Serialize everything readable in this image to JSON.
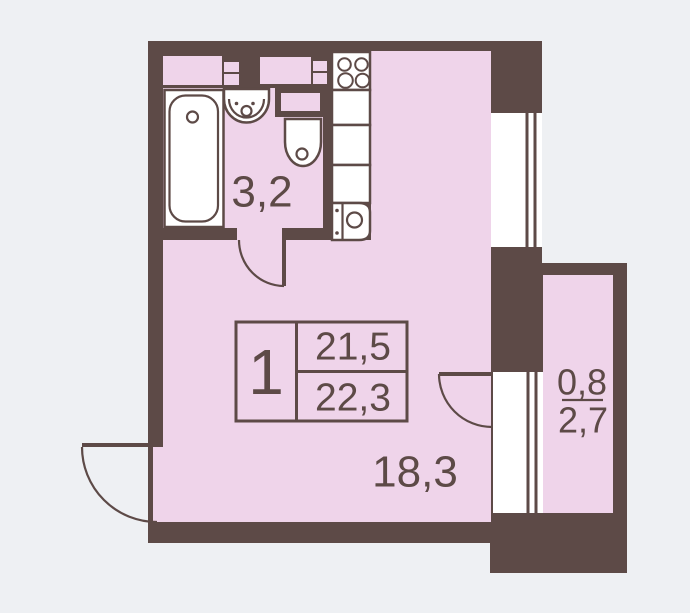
{
  "plan_title": "Studio apartment floor plan",
  "colors": {
    "wall": "#5D4A47",
    "floor": "#EFD4EA",
    "bg": "#EEF0F3",
    "fixture": "#FFFFFF"
  },
  "info_box": {
    "unit_number": "1",
    "total_area": "21,5",
    "living_area": "22,3"
  },
  "labels": {
    "bathroom_area": "3,2",
    "main_room_area": "18,3",
    "balcony_coefficient": "0,8",
    "balcony_area": "2,7"
  },
  "fixtures": [
    "bathtub",
    "washbasin",
    "toilet",
    "stove",
    "kitchen-counter",
    "kitchen-sink",
    "window",
    "balcony-door",
    "entry-door",
    "bathroom-door",
    "vent-shaft"
  ]
}
